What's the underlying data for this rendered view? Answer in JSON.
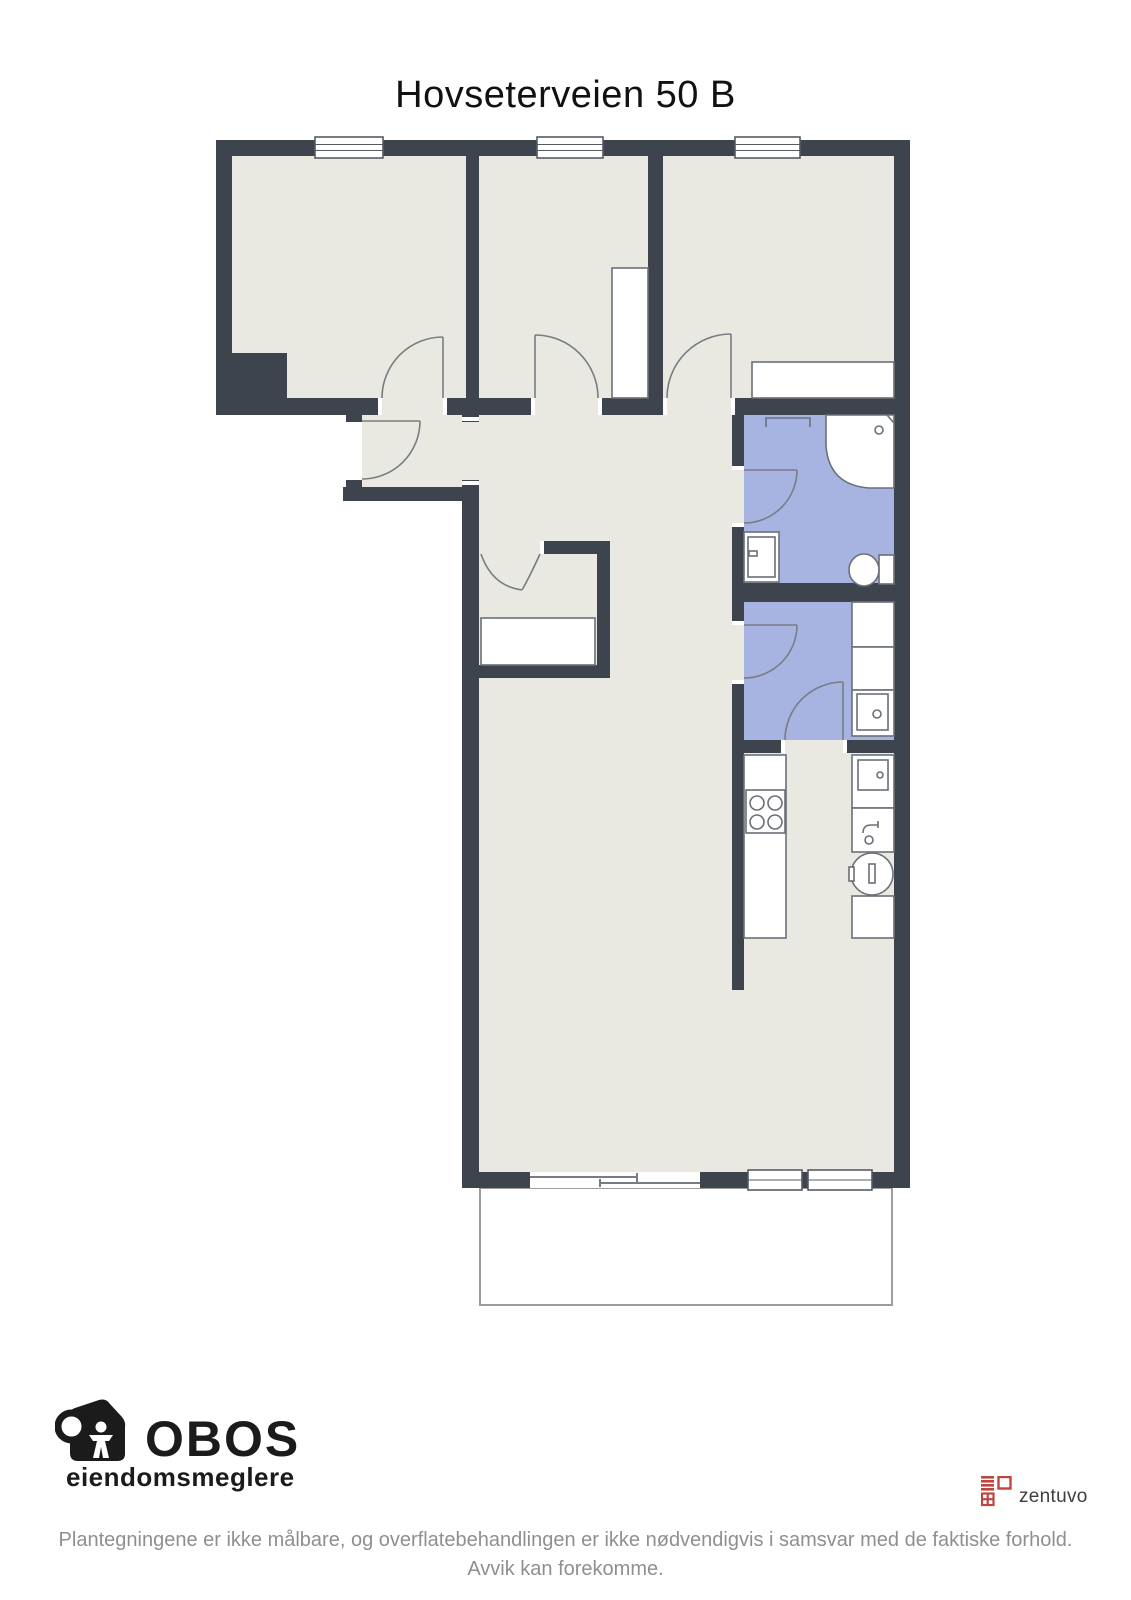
{
  "title": "Hovseterveien 50 B",
  "footer": {
    "obos_name": "OBOS",
    "obos_subtitle": "eiendomsmeglere",
    "zentuvo_name": "zentuvo",
    "disclaimer_line1": "Plantegningene er ikke målbare, og overflatebehandlingen er ikke nødvendigvis i samsvar med de faktiske forhold.",
    "disclaimer_line2": "Avvik kan forekomme."
  },
  "colors": {
    "wall": "#3e444e",
    "floor": "#eae9e1",
    "wet_room": "#a7b4e2",
    "fixture_line": "#6b7077",
    "door_line": "#787d84",
    "window_line": "#565b63",
    "balcony_line": "#9c9c9c",
    "brand_red": "#bf4640",
    "zentuvo_text": "#3e3e40",
    "disclaimer_gray": "#8f8f8f",
    "title_black": "#111111",
    "logo_black": "#1b1b1b"
  }
}
